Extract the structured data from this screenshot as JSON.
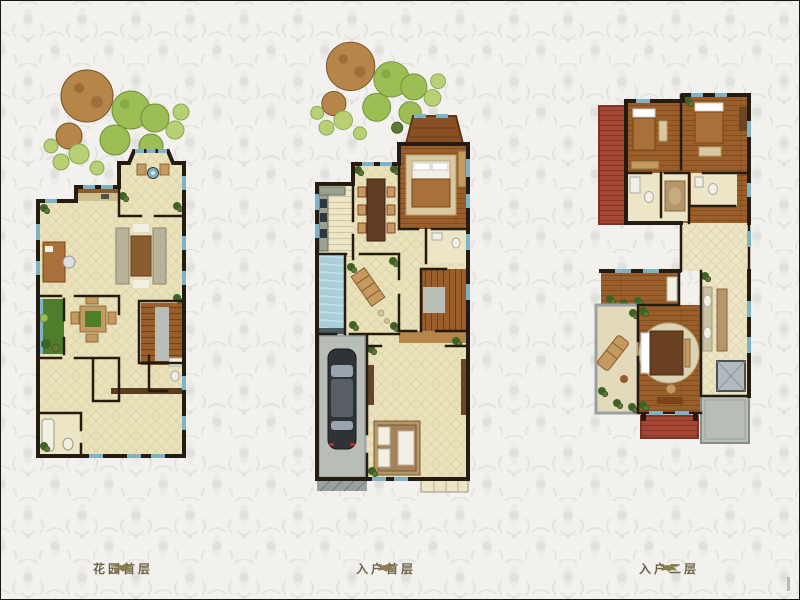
{
  "page": {
    "background_color": "#f2f1ee",
    "border_color": "#161616",
    "description": "Three residential floor plans on a damask wallpaper background"
  },
  "palette": {
    "wall": "#241b11",
    "floor": "#eae2bb",
    "tile": "#ece5c6",
    "lattice": "#d2c89a",
    "wood": "#9a5e2a",
    "wood_dark": "#7c4418",
    "wood_light": "#b5854a",
    "window": "#7fb2c4",
    "pool": "#a8cfda",
    "garden": "#4e7d2b",
    "shrub": "#3f6323",
    "tree_green": "#9dbd55",
    "tree_light": "#b7d076",
    "tree_brown": "#b5854a",
    "terrace_red": "#a54734",
    "concrete": "#b9bdb8",
    "counter": "#9aa08f",
    "fabric": "#c49a60",
    "rug": "#b5956a",
    "caption": "#6e6247",
    "ornament": "#8d7b52"
  },
  "plans": [
    {
      "id": "garden-ground-floor",
      "caption": "花园首层"
    },
    {
      "id": "entry-ground-floor",
      "caption": "入户首层"
    },
    {
      "id": "entry-second-floor",
      "caption": "入户二层"
    }
  ]
}
